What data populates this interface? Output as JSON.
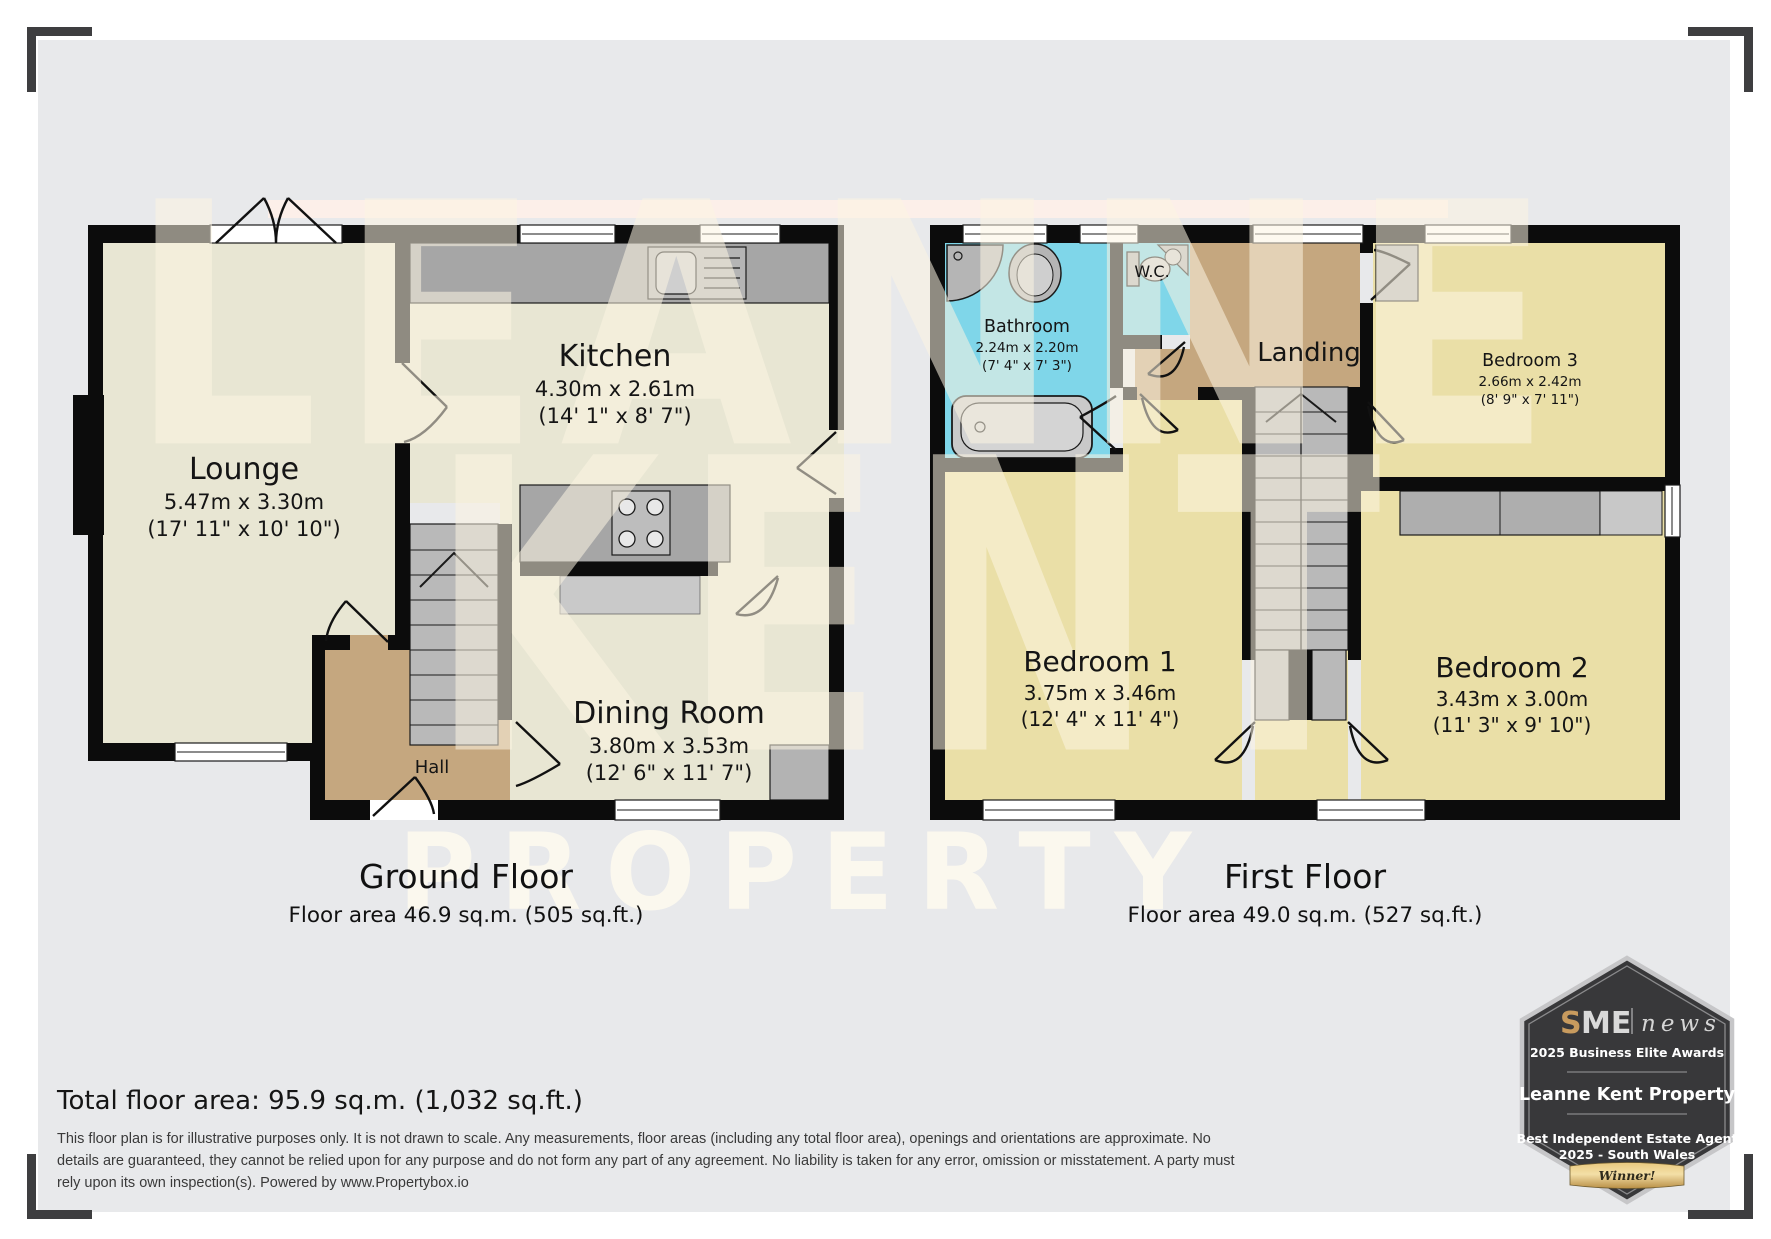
{
  "ground_floor": {
    "caption": "Ground Floor",
    "area_label": "Floor area 46.9 sq.m. (505 sq.ft.)",
    "rooms": {
      "lounge": {
        "name": "Lounge",
        "metric": "5.47m x 3.30m",
        "imperial": "(17' 11\" x 10' 10\")"
      },
      "kitchen": {
        "name": "Kitchen",
        "metric": "4.30m x 2.61m",
        "imperial": "(14' 1\" x 8' 7\")"
      },
      "dining_room": {
        "name": "Dining Room",
        "metric": "3.80m x 3.53m",
        "imperial": "(12' 6\" x 11' 7\")"
      },
      "hall": {
        "name": "Hall"
      }
    }
  },
  "first_floor": {
    "caption": "First Floor",
    "area_label": "Floor area 49.0 sq.m. (527 sq.ft.)",
    "rooms": {
      "bathroom": {
        "name": "Bathroom",
        "metric": "2.24m x 2.20m",
        "imperial": "(7' 4\" x 7' 3\")"
      },
      "wc": {
        "name": "W.C."
      },
      "landing": {
        "name": "Landing"
      },
      "bedroom1": {
        "name": "Bedroom 1",
        "metric": "3.75m x 3.46m",
        "imperial": "(12' 4\" x 11' 4\")"
      },
      "bedroom2": {
        "name": "Bedroom 2",
        "metric": "3.43m x 3.00m",
        "imperial": "(11' 3\" x 9' 10\")"
      },
      "bedroom3": {
        "name": "Bedroom 3",
        "metric": "2.66m x 2.42m",
        "imperial": "(8' 9\" x 7' 11\")"
      }
    }
  },
  "summary": {
    "total_area": "Total floor area: 95.9 sq.m. (1,032 sq.ft.)"
  },
  "disclaimer": "This floor plan is for illustrative purposes only. It is not drawn to scale. Any measurements, floor areas (including any total floor area), openings and orientations are approximate. No details are guaranteed, they cannot be relied upon for any purpose and do not form any part of any agreement. No liability is taken for any error, omission or misstatement. A party must rely upon its own inspection(s). Powered by www.Propertybox.io",
  "watermark": {
    "word1": "LEANNE",
    "word2": "KENT",
    "word3": "PROPERTY"
  },
  "badge": {
    "sme_s": "S",
    "sme_me": "ME",
    "sme_news": "news",
    "awards_line": "2025 Business Elite Awards",
    "company": "Leanne Kent Property",
    "award_title_1": "Best Independent Estate Agent",
    "award_title_2": "2025 - South Wales",
    "ribbon": "Winner!"
  },
  "colors": {
    "room_beige": "#e8e6d3",
    "room_yellow": "#eadfa7",
    "room_tan": "#c5a77f",
    "room_cyan": "#7fd6e9",
    "wall": "#0c0c0c",
    "fixture_gray": "#b9b9b9",
    "badge_dark": "#38383a",
    "gold": "#c89b5e",
    "pink_strip": "#fcefe9",
    "panel": "#e8e9eb"
  }
}
